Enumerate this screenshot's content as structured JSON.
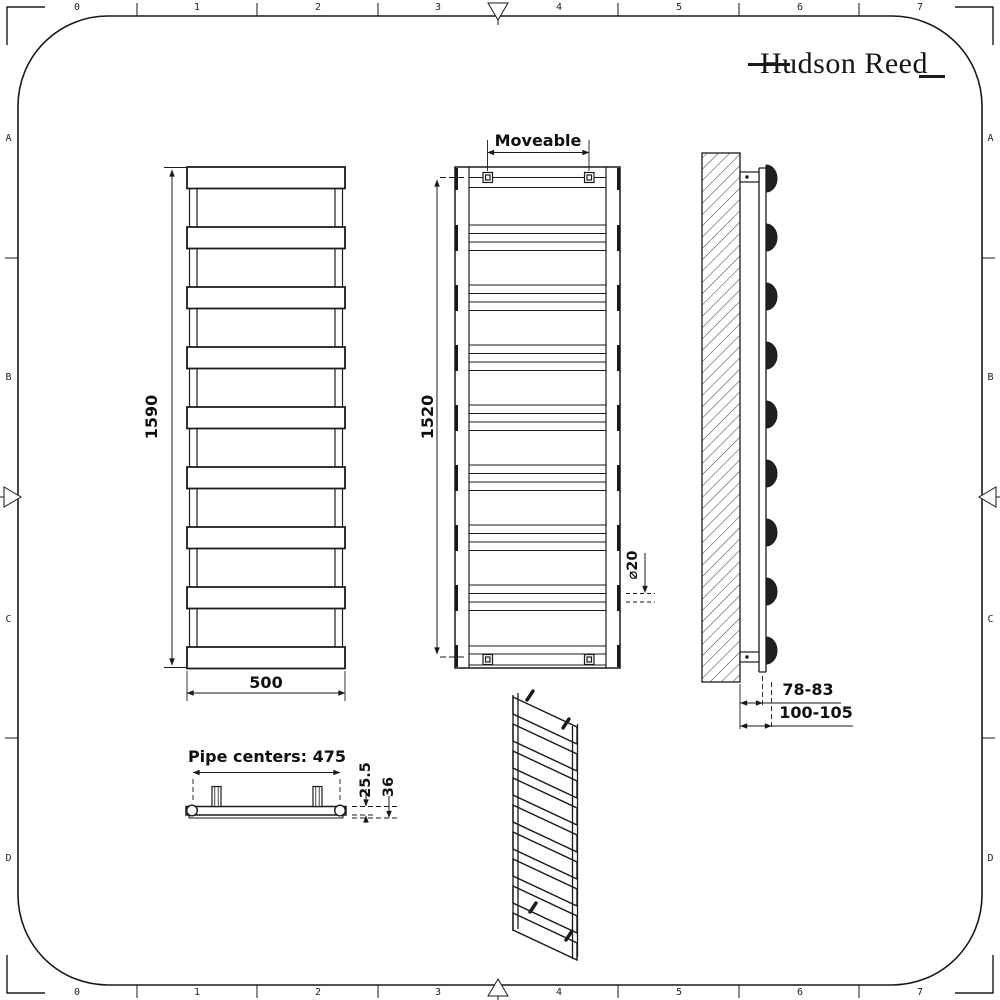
{
  "brand": {
    "name": "Hudson Reed"
  },
  "frame": {
    "top_ruler": [
      "0",
      "1",
      "2",
      "3",
      "4",
      "5",
      "6",
      "7"
    ],
    "bottom_ruler": [
      "0",
      "1",
      "2",
      "3",
      "4",
      "5",
      "6",
      "7"
    ],
    "left_ruler": [
      "A",
      "B",
      "C",
      "D"
    ],
    "right_ruler": [
      "A",
      "B",
      "C",
      "D"
    ]
  },
  "views": {
    "front": {
      "height": "1590",
      "width": "500"
    },
    "rear": {
      "bracket_span": "Moveable",
      "height": "1520",
      "tube_diameter": "⌀20"
    },
    "side": {
      "wall_to_bracket": "78-83",
      "wall_to_front": "100-105"
    },
    "top": {
      "pipe_centers": "Pipe centers: 475",
      "bar_depth": "25.5",
      "total_depth": "36"
    }
  },
  "colors": {
    "line": "#1a1a1a",
    "background": "#ffffff"
  }
}
